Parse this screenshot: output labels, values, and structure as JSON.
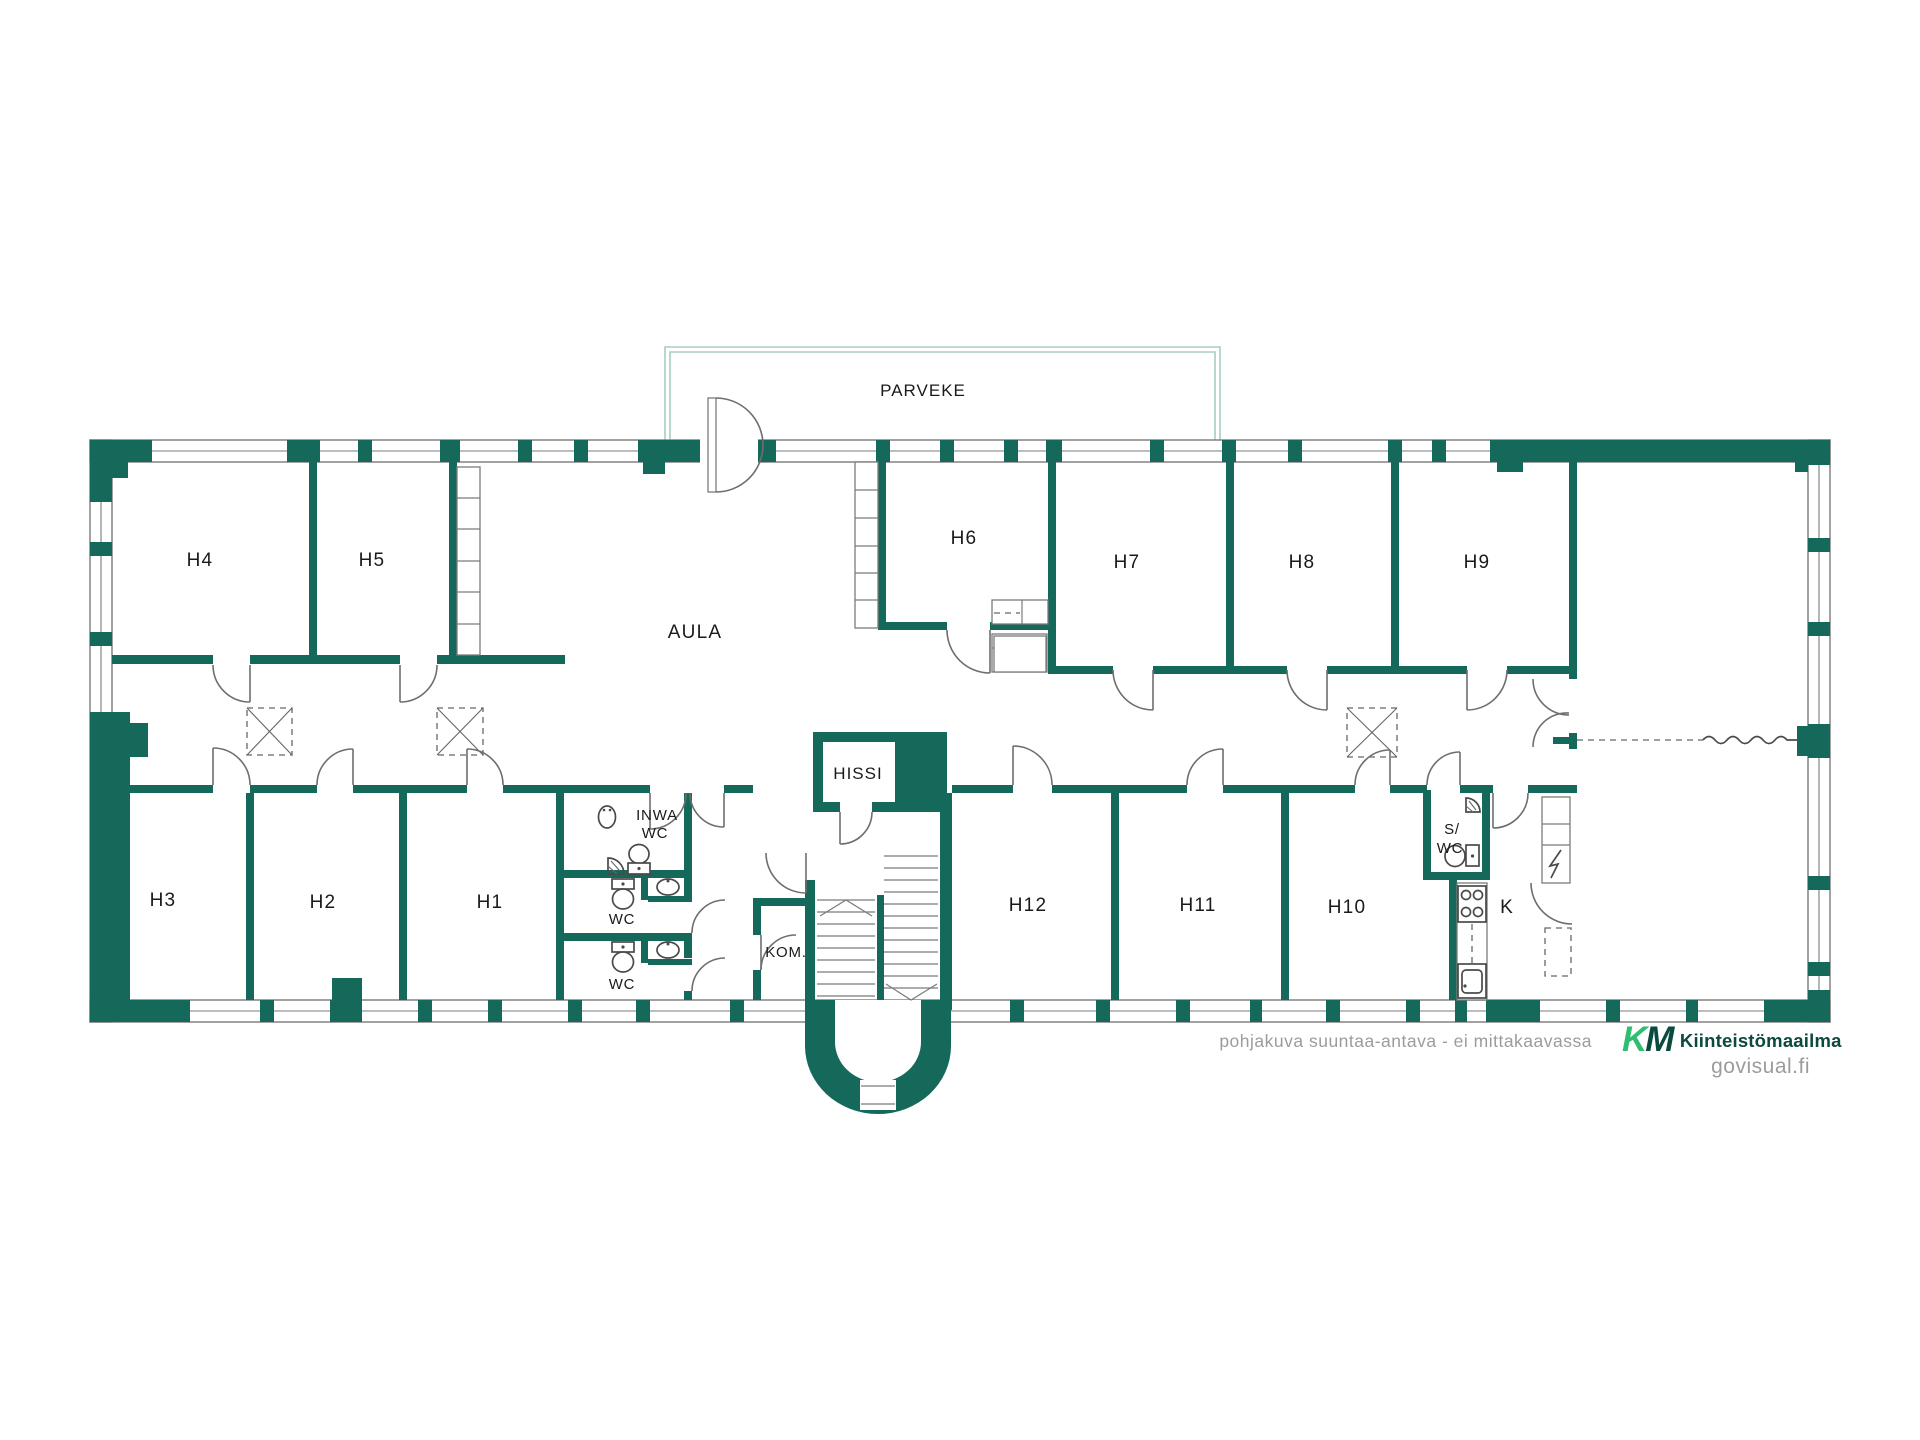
{
  "colors": {
    "wall": "#15695B",
    "balcony_outline": "#A9CDC3",
    "line": "#7b7b7b",
    "fixture": "#4a4a4a",
    "label": "#1a1a1a",
    "muted": "#9c9c9c",
    "logo_green": "#2FBE70",
    "logo_teal": "#0B4A3F"
  },
  "labels": {
    "parveke": "PARVEKE",
    "aula": "AULA",
    "hissi": "HISSI",
    "kom": "KOM.",
    "inwa": "INWA",
    "wc": "WC",
    "s_upper": "S/",
    "k": "K",
    "h1": "H1",
    "h2": "H2",
    "h3": "H3",
    "h4": "H4",
    "h5": "H5",
    "h6": "H6",
    "h7": "H7",
    "h8": "H8",
    "h9": "H9",
    "h10": "H10",
    "h11": "H11",
    "h12": "H12"
  },
  "footer": {
    "disclaimer": "pohjakuva suuntaa-antava - ei mittakaavassa",
    "logo_k": "K",
    "logo_m": "M",
    "brand": "Kiinteistömaailma",
    "site": "govisual.fi"
  }
}
